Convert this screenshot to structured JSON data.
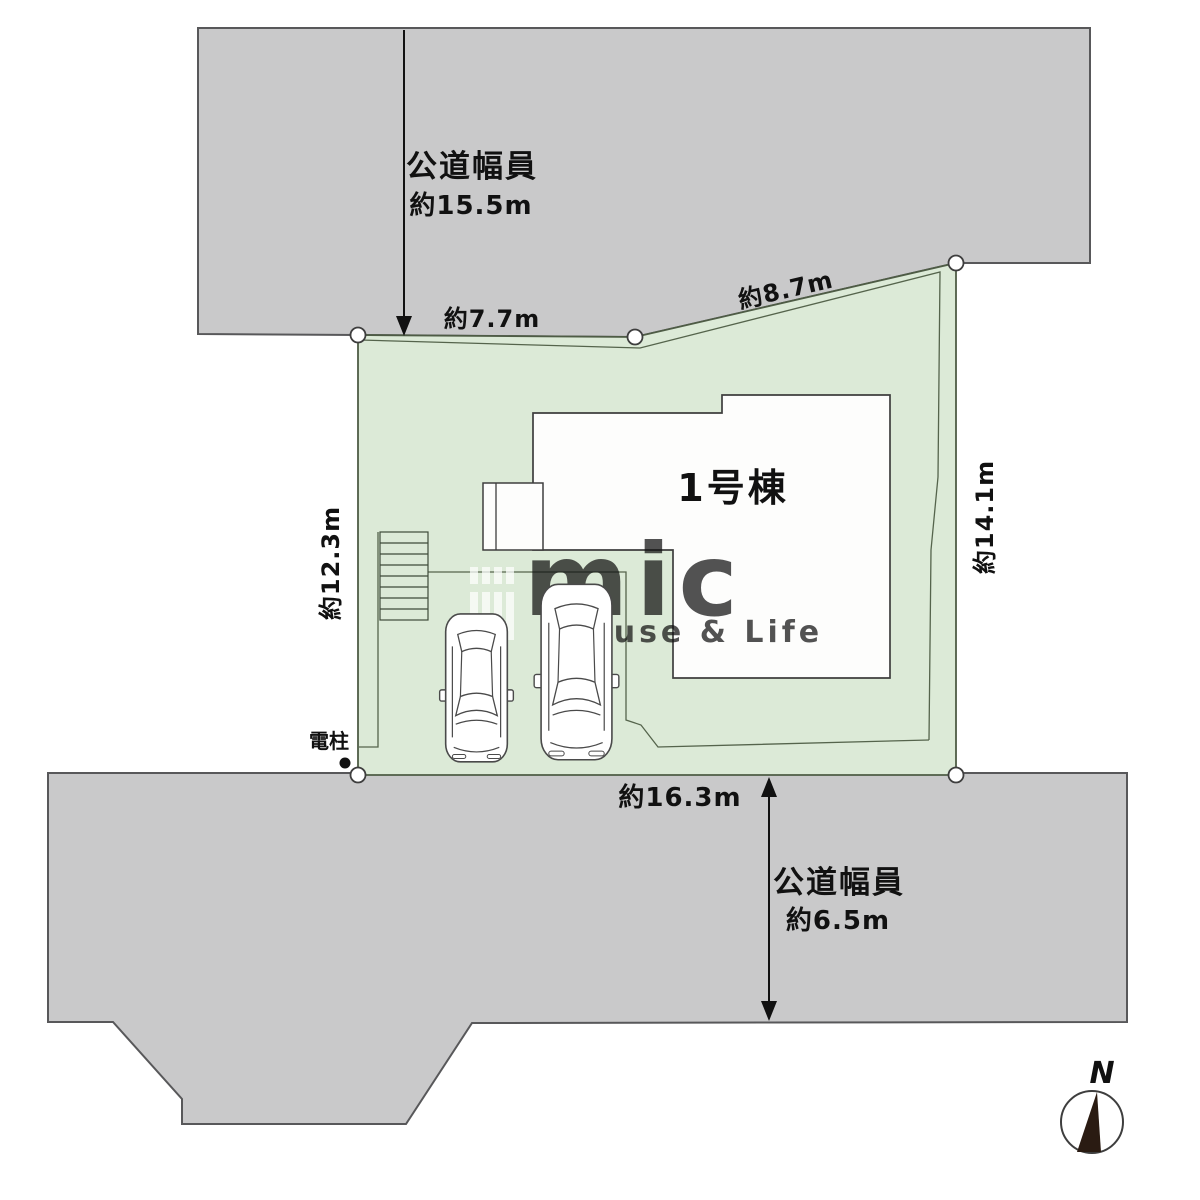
{
  "roads": {
    "top": {
      "label": "公道幅員",
      "width_value": "約15.5m"
    },
    "bottom": {
      "label": "公道幅員",
      "width_value": "約6.5m"
    }
  },
  "plot": {
    "building_label": "1号棟",
    "boundary_lengths": {
      "top_left": "約7.7m",
      "top_right": "約8.7m",
      "right": "約14.1m",
      "left": "約12.3m",
      "bottom": "約16.3m"
    },
    "utility_pole": "電柱"
  },
  "compass": {
    "north_label": "N"
  },
  "watermark": {
    "brand": "mic",
    "tagline": "House & Life"
  },
  "colors": {
    "road_fill": "#c9c9ca",
    "road_stroke": "#58585a",
    "plot_fill": "#dcead7",
    "plot_stroke": "#4e5c45",
    "outline_dark": "#3e3e3e",
    "needle": "#2a1b12"
  }
}
